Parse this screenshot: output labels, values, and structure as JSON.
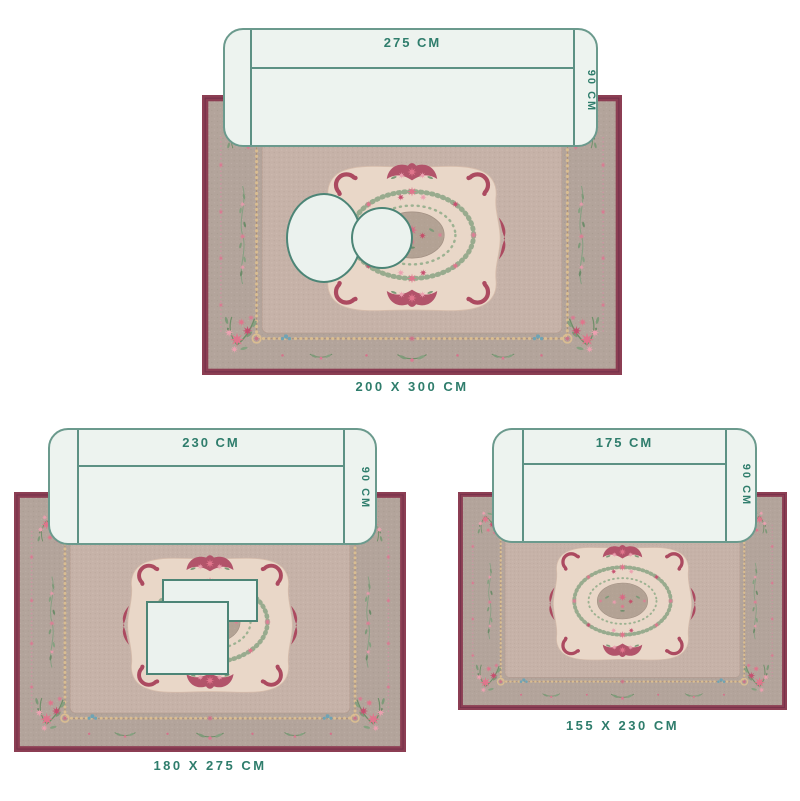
{
  "title": "rug-size-guide",
  "colors": {
    "label_teal": "#2F7D6C",
    "sofa_fill": "#EDF3EF",
    "sofa_border": "#6B9A8D",
    "table_fill": "#EBF2EE",
    "table_border": "#4C8576",
    "rug_border_maroon": "#8C3E53",
    "rug_field_taupe": "#B3A49B",
    "rug_inner_mauve": "#C6B2A8",
    "rug_panel_cream": "#E9D7C8",
    "ornament_crimson": "#AC4A60",
    "rose_pink": "#E0758C",
    "leaf_green": "#7E9A79",
    "bead_gold": "#D9BD92",
    "accent_blue": "#6FA3B4"
  },
  "diagrams": [
    {
      "name": "rug-200x300",
      "size_label": "200 X 300 CM",
      "sofa": {
        "width_label": "275 CM",
        "depth_label": "90 CM"
      }
    },
    {
      "name": "rug-180x275",
      "size_label": "180 X 275 CM",
      "sofa": {
        "width_label": "230 CM",
        "depth_label": "90 CM"
      }
    },
    {
      "name": "rug-155x230",
      "size_label": "155 X 230 CM",
      "sofa": {
        "width_label": "175 CM",
        "depth_label": "90 CM"
      }
    }
  ]
}
